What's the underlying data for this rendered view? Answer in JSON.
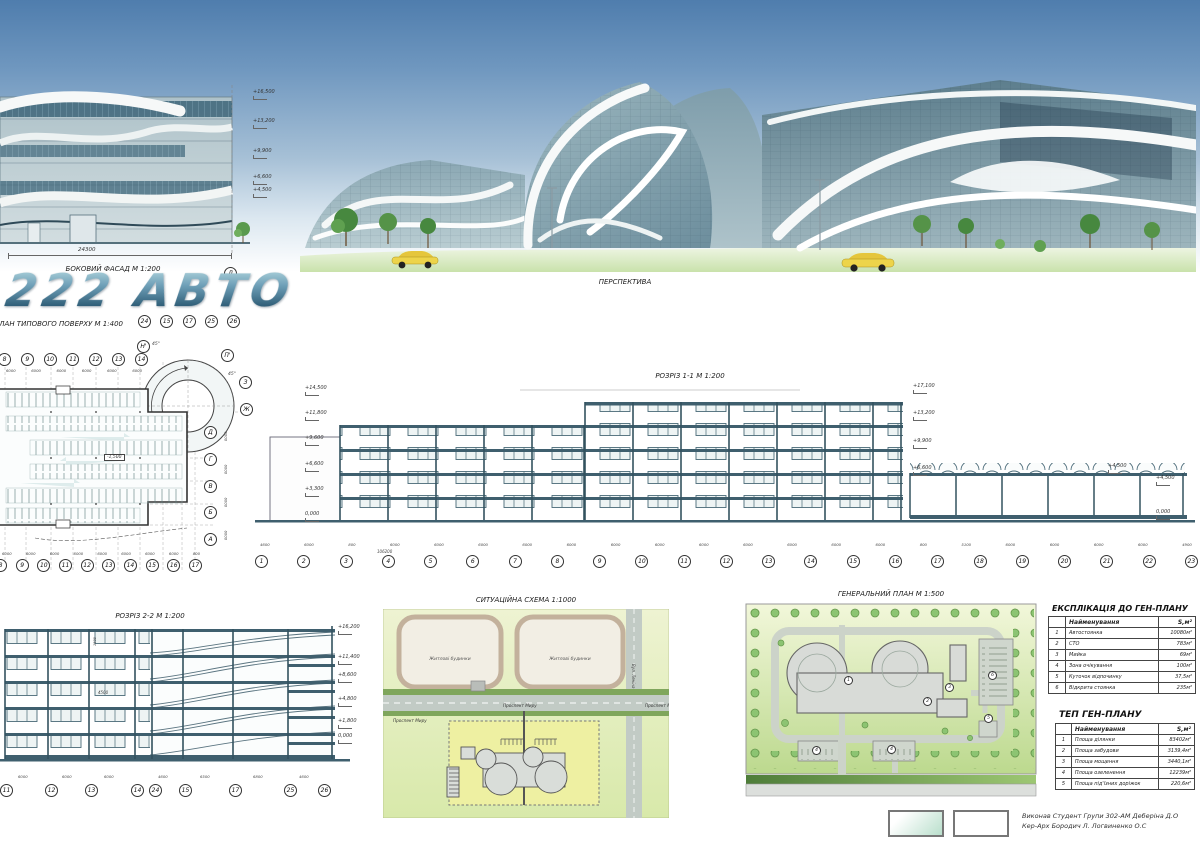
{
  "board": {
    "logo": "222 АВТО",
    "credits_line1": "Виконав  Студент  Групи 302-АМ  Деберіна Д.О",
    "credits_line2": "Кер-Арх Бородич Л.    Логвиненко О.С"
  },
  "facade": {
    "title": "БОКОВИЙ ФАСАД М 1:200",
    "total_dim": "24300",
    "axis_bubble": "Л",
    "elevations": [
      "+16,500",
      "+13,200",
      "+9,900",
      "+6,600",
      "+4,500"
    ]
  },
  "perspective": {
    "title": "ПЕРСПЕКТИВА"
  },
  "plan": {
    "title": "ПЛАН ТИПОВОГО ПОВЕРХУ М 1:400",
    "level_label": "-1,500",
    "angle1": "45°",
    "angle2": "45°",
    "ramp_bubbles": [
      "24",
      "15",
      "17",
      "25",
      "26"
    ],
    "top_bubbles": [
      "8",
      "9",
      "10",
      "11",
      "12",
      "13",
      "14"
    ],
    "bottom_bubbles": [
      "8",
      "9",
      "10",
      "11",
      "12",
      "13",
      "14",
      "15",
      "16",
      "17"
    ],
    "right_bubbles": [
      "Д",
      "Г",
      "В",
      "Б",
      "А"
    ],
    "corner_bubbles": [
      "Н'",
      "П'",
      "З",
      "Ж"
    ],
    "top_dims": [
      "6000",
      "6000",
      "6000",
      "6000",
      "6000",
      "6000"
    ],
    "bottom_dims": [
      "6000",
      "6000",
      "6000",
      "6000",
      "6000",
      "6000",
      "6000",
      "6000",
      "800"
    ],
    "right_dims": [
      "6000",
      "6000",
      "6000",
      "6000"
    ]
  },
  "section1": {
    "title": "РОЗРІЗ 1-1 М 1:200",
    "total_dim": "106200",
    "roof_mark": "+4,500",
    "elev_left": [
      "+14,500",
      "+11,800",
      "+9,600",
      "+6,600",
      "+3,300",
      "0,000"
    ],
    "elev_mid": [
      "+17,100",
      "+13,200",
      "+9,900",
      "+6,600"
    ],
    "elev_right": [
      "+4,500",
      "0,000"
    ],
    "bubbles": [
      "1",
      "2",
      "3",
      "4",
      "5",
      "6",
      "7",
      "8",
      "9",
      "10",
      "11",
      "12",
      "13",
      "14",
      "15",
      "16",
      "17",
      "18",
      "19",
      "20",
      "21",
      "22",
      "23"
    ],
    "dims": [
      "4600",
      "6000",
      "800",
      "6000",
      "6000",
      "6000",
      "6000",
      "6000",
      "6000",
      "6000",
      "6000",
      "6000",
      "6000",
      "6000",
      "6000",
      "800",
      "5100",
      "6000",
      "6000",
      "6000",
      "6000",
      "4900"
    ]
  },
  "section2": {
    "title": "РОЗРІЗ 2-2 М 1:200",
    "window_dim": "4500",
    "sill_dim": "1500",
    "elevations": [
      "+16,200",
      "+11,400",
      "+8,600",
      "+4,800",
      "+1,800",
      "0,000"
    ],
    "bubbles": [
      "11",
      "12",
      "13",
      "14",
      "24",
      "15",
      "17",
      "25",
      "26"
    ],
    "dims": [
      "6000",
      "6000",
      "6000",
      "4600",
      "6500",
      "6800",
      "4600"
    ]
  },
  "situation": {
    "title": "СИТУАЦІЙНА СХЕМА 1:1000",
    "block1_label": "Житлові будинки",
    "block2_label": "Житлові будинки",
    "street_vertical": "Вул. Леніна",
    "avenue_label1": "Проспект Миру",
    "avenue_label2": "Проспект Миру",
    "avenue_label3": "Проспект Миру"
  },
  "genplan": {
    "title": "ГЕНЕРАЛЬНИЙ ПЛАН М 1:500",
    "markers": [
      "1",
      "2",
      "3",
      "4",
      "4",
      "5",
      "6"
    ]
  },
  "explication": {
    "title": "ЕКСПЛІКАЦІЯ ДО ГЕН-ПЛАНУ",
    "col_name": "Найменування",
    "col_area": "S,м²",
    "rows": [
      {
        "num": "1",
        "name": "Автостоянка",
        "area": "10080м²"
      },
      {
        "num": "2",
        "name": "СТО",
        "area": "783м²"
      },
      {
        "num": "3",
        "name": "Мийка",
        "area": "69м²"
      },
      {
        "num": "4",
        "name": "Зона очікування",
        "area": "100м²"
      },
      {
        "num": "5",
        "name": "Куточок відпочинку",
        "area": "37,5м²"
      },
      {
        "num": "6",
        "name": "Відкрита стоянка",
        "area": "235м²"
      }
    ]
  },
  "tep": {
    "title": "ТЕП ГЕН-ПЛАНУ",
    "col_name": "Найменування",
    "col_area": "S,м²",
    "rows": [
      {
        "num": "1",
        "name": "Площа ділянки",
        "area": "83402м²"
      },
      {
        "num": "2",
        "name": "Площа забудови",
        "area": "3139,4м²"
      },
      {
        "num": "3",
        "name": "Площа мощення",
        "area": "3440,1м²"
      },
      {
        "num": "4",
        "name": "Площа озеленення",
        "area": "12239м²"
      },
      {
        "num": "5",
        "name": "Площа під'їзних доріжок",
        "area": "220,6м²"
      }
    ]
  }
}
